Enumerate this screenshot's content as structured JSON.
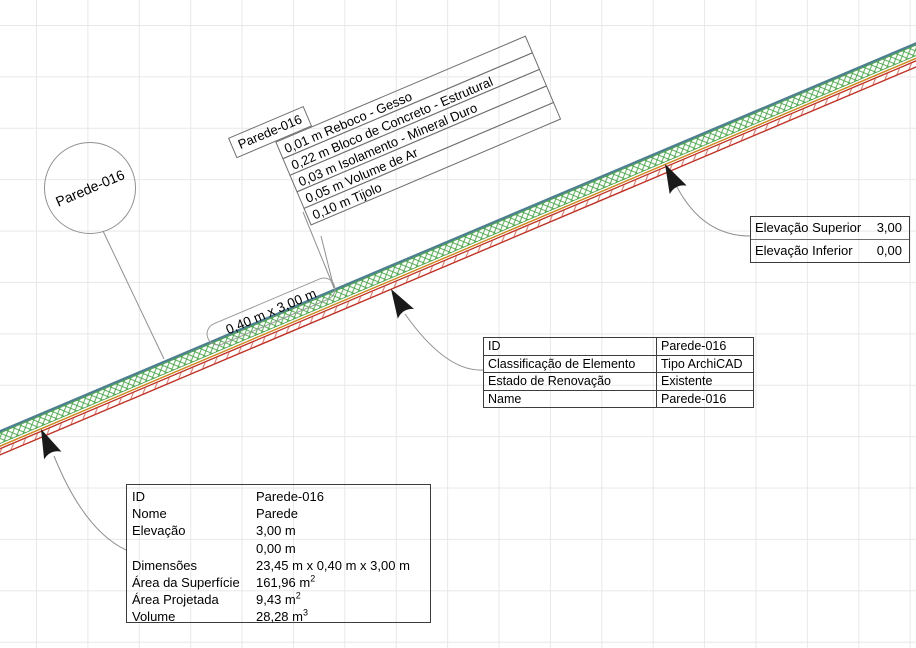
{
  "drawing": {
    "tool": "ArchiCAD plan view",
    "element_id": "Parede-016"
  },
  "bubble_label": {
    "text": "Parede-016"
  },
  "dimension_tag": {
    "text": "0,40 m x 3,00 m"
  },
  "layers_label": {
    "title": "Parede-016",
    "rows": [
      "0,01 m  Reboco - Gesso",
      "0,22 m  Bloco de Concreto - Estrutural",
      "0,03 m  Isolamento - Mineral Duro",
      "0,05 m  Volume de Ar",
      "0,10 m  Tijolo"
    ]
  },
  "elevation_table": {
    "rows": [
      {
        "label": "Elevação Superior",
        "value": "3,00"
      },
      {
        "label": "Elevação Inferior",
        "value": "0,00"
      }
    ]
  },
  "id_table": {
    "rows": [
      {
        "label": "ID",
        "value": "Parede-016"
      },
      {
        "label": "Classificação de Elemento",
        "value": "Tipo ArchiCAD"
      },
      {
        "label": "Estado de Renovação",
        "value": "Existente"
      },
      {
        "label": "Name",
        "value": "Parede-016"
      }
    ]
  },
  "properties_table": {
    "rows": [
      {
        "label": "ID",
        "value": "Parede-016",
        "sup": ""
      },
      {
        "label": "Nome",
        "value": "Parede",
        "sup": ""
      },
      {
        "label": "Elevação",
        "value": "3,00 m",
        "sup": ""
      },
      {
        "label": "",
        "value": "0,00 m",
        "sup": ""
      },
      {
        "label": "Dimensões",
        "value": "23,45 m x 0,40 m x 3,00 m",
        "sup": ""
      },
      {
        "label": "Área da Superfície",
        "value": "161,96 m",
        "sup": "2"
      },
      {
        "label": "Área Projetada",
        "value": "9,43 m",
        "sup": "2"
      },
      {
        "label": "Volume",
        "value": "28,28 m",
        "sup": "3"
      }
    ]
  },
  "colors": {
    "grid_line": "#e8e8e8",
    "wall_teal": "#4d7f8f",
    "hatch_green": "#44a244",
    "wall_orange": "#cc861c",
    "wall_red": "#c03226",
    "hatch_red": "#d4756a",
    "leader_gray": "#909090",
    "arrow_black": "#1a1a1a"
  }
}
